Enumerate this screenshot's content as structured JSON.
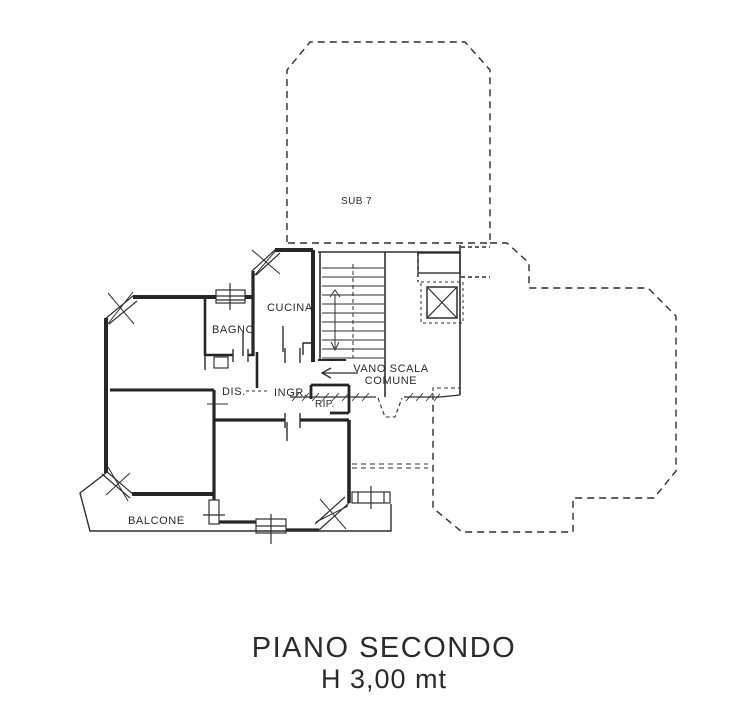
{
  "plan": {
    "sub_label": "SUB 7",
    "rooms": {
      "cucina": "CUCINA",
      "bagno": "BAGNO",
      "dis": "DIS.",
      "ingr": "INGR.",
      "rip": "RIP.",
      "vano_scala_line1": "VANO SCALA",
      "vano_scala_line2": "COMUNE",
      "balcone": "BALCONE"
    },
    "title_line1": "PIANO SECONDO",
    "title_line2": "H 3,00 mt",
    "ink_color": "#2f2f2f",
    "background_color": "#ffffff"
  }
}
